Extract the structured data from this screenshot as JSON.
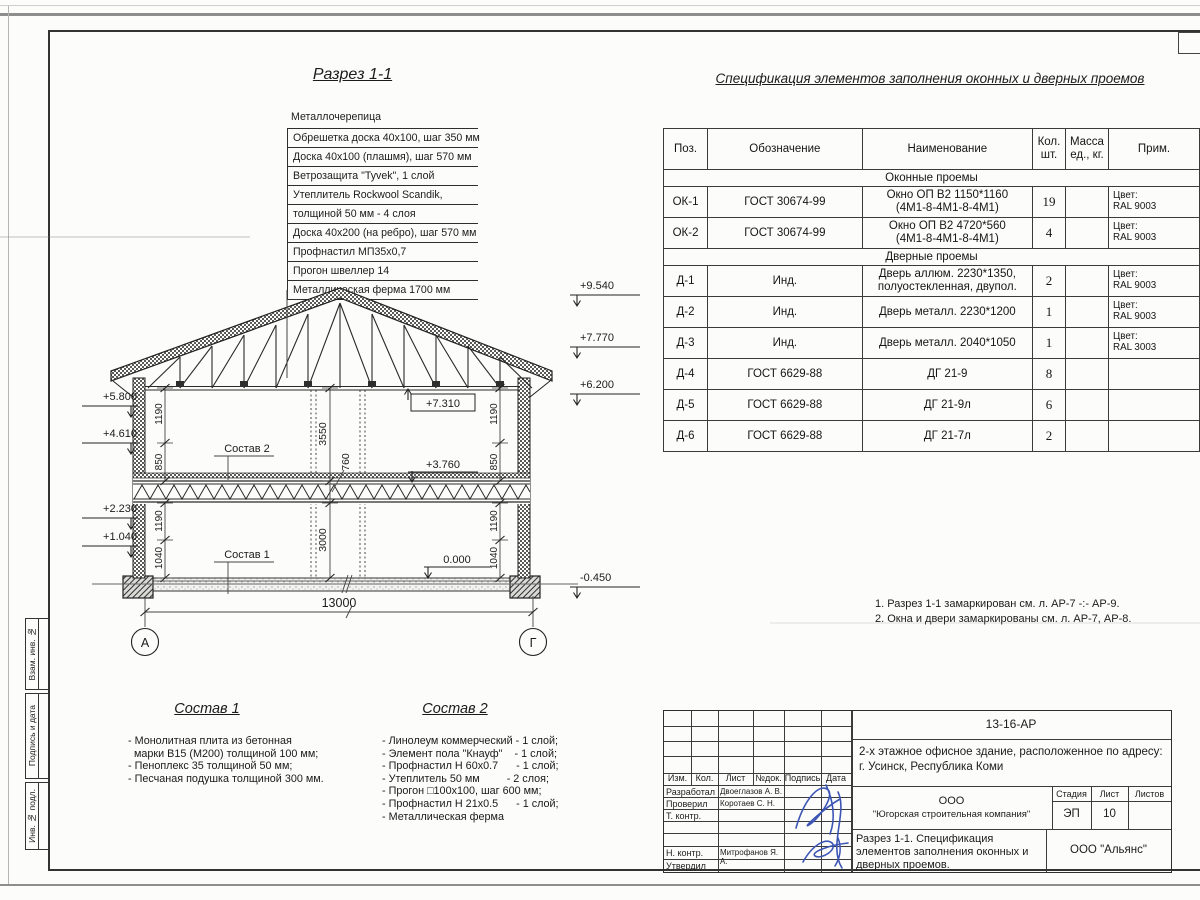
{
  "drawing": {
    "section_title": "Разрез 1-1",
    "roof": {
      "top_label": "Металлочерепица",
      "layers": [
        "Обрешетка доска 40х100, шаг 350 мм",
        "Доска 40х100 (плашмя), шаг 570 мм",
        "Ветрозащита \"Tyvek\", 1 слой",
        "Утеплитель Rockwool Scandik,",
        "толщиной 50 мм - 4 слоя",
        "Доска 40х200 (на ребро), шаг 570 мм",
        "Профнастил МП35х0,7",
        "Прогон швеллер 14",
        "Металлическая ферма 1700 мм"
      ]
    },
    "elevations": {
      "left": [
        "+5.800",
        "+4.610",
        "+2.230",
        "+1.040"
      ],
      "right": [
        "+9.540",
        "+7.770",
        "+6.200",
        "-0.450"
      ],
      "interior": [
        "+7.310",
        "+3.760",
        "0.000"
      ]
    },
    "dimensions": {
      "overall_width": "13000",
      "floor2_height": "3550",
      "floor_thickness": "760",
      "floor1_height": "3000",
      "win_sill_upper": "850",
      "win_height": "1190",
      "win_sill_lower": "1040"
    },
    "axes": {
      "left": "А",
      "right": "Г"
    },
    "leader_labels": {
      "sostav2": "Состав 2",
      "sostav1": "Состав 1"
    }
  },
  "spec": {
    "title": "Спецификация элементов заполнения оконных и дверных проемов",
    "headers": {
      "pos": "Поз.",
      "designation": "Обозначение",
      "name": "Наименование",
      "qty1": "Кол.",
      "qty2": "шт.",
      "mass1": "Масса",
      "mass2": "ед., кг.",
      "note": "Прим."
    },
    "group_windows": "Оконные проемы",
    "group_doors": "Дверные проемы",
    "rows": [
      {
        "pos": "ОК-1",
        "designation": "ГОСТ 30674-99",
        "name1": "Окно ОП В2 1150*1160",
        "name2": "(4М1-8-4М1-8-4М1)",
        "qty": "19",
        "note1": "Цвет:",
        "note2": "RAL 9003"
      },
      {
        "pos": "ОК-2",
        "designation": "ГОСТ 30674-99",
        "name1": "Окно ОП В2 4720*560",
        "name2": "(4М1-8-4М1-8-4М1)",
        "qty": "4",
        "note1": "Цвет:",
        "note2": "RAL 9003"
      },
      {
        "pos": "Д-1",
        "designation": "Инд.",
        "name1": "Дверь аллюм. 2230*1350,",
        "name2": "полуостекленная, двупол.",
        "qty": "2",
        "note1": "Цвет:",
        "note2": "RAL 9003"
      },
      {
        "pos": "Д-2",
        "designation": "Инд.",
        "name1": "Дверь металл. 2230*1200",
        "name2": "",
        "qty": "1",
        "note1": "Цвет:",
        "note2": "RAL 9003"
      },
      {
        "pos": "Д-3",
        "designation": "Инд.",
        "name1": "Дверь металл. 2040*1050",
        "name2": "",
        "qty": "1",
        "note1": "Цвет:",
        "note2": "RAL 3003"
      },
      {
        "pos": "Д-4",
        "designation": "ГОСТ 6629-88",
        "name1": "ДГ 21-9",
        "name2": "",
        "qty": "8",
        "note1": "",
        "note2": ""
      },
      {
        "pos": "Д-5",
        "designation": "ГОСТ 6629-88",
        "name1": "ДГ 21-9л",
        "name2": "",
        "qty": "6",
        "note1": "",
        "note2": ""
      },
      {
        "pos": "Д-6",
        "designation": "ГОСТ 6629-88",
        "name1": "ДГ 21-7л",
        "name2": "",
        "qty": "2",
        "note1": "",
        "note2": ""
      }
    ],
    "notes": [
      "1. Разрез 1-1 замаркирован см. л. АР-7 -:- АР-9.",
      "2. Окна и двери замаркированы см. л. АР-7, АР-8."
    ]
  },
  "compositions": {
    "c1": {
      "title": "Состав 1",
      "lines": [
        "- Монолитная плита из бетонная",
        "  марки В15 (М200) толщиной 100 мм;",
        "- Пеноплекс 35 толщиной 50 мм;",
        "- Песчаная подушка толщиной 300 мм."
      ]
    },
    "c2": {
      "title": "Состав 2",
      "lines": [
        "- Линолеум коммерческий - 1 слой;",
        "- Элемент пола \"Кнауф\"    - 1 слой;",
        "- Профнастил Н 60х0.7      - 1 слой;",
        "- Утеплитель 50 мм         - 2 слоя;",
        "- Прогон □100х100, шаг 600 мм;",
        "- Профнастил Н 21х0.5      - 1 слой;",
        "- Металлическая ферма"
      ]
    }
  },
  "title_block": {
    "doc_code": "13-16-АР",
    "object_line1": "2-х этажное офисное здание, расположенное по адресу:",
    "object_line2": "г. Усинск, Республика Коми",
    "company_line1": "ООО",
    "company_line2": "\"Югорская строительная компания\"",
    "stage_label": "Стадия",
    "sheet_label": "Лист",
    "sheets_label": "Листов",
    "stage": "ЭП",
    "sheet_no": "10",
    "sheet_title": "Разрез 1-1. Спецификация элементов заполнения оконных и дверных проемов.",
    "contractor": "ООО \"Альянс\"",
    "cols": {
      "izm": "Изм.",
      "kol": "Кол.",
      "list": "Лист",
      "ndok": "№док.",
      "podpis": "Подпись",
      "data": "Дата"
    },
    "roles": [
      {
        "label": "Разработал",
        "name": "Двоеглазов А. В."
      },
      {
        "label": "Проверил",
        "name": "Коротаев С. Н."
      },
      {
        "label": "Т. контр.",
        "name": ""
      },
      {
        "label": "Н. контр.",
        "name": "Митрофанов Я. А."
      },
      {
        "label": "Утвердил",
        "name": ""
      }
    ]
  },
  "side_labels": [
    "Взам. инв. №",
    "Подпись и дата",
    "Инв. № подл."
  ],
  "colors": {
    "line": "#2e2e2e",
    "signature": "#3c55b5"
  }
}
